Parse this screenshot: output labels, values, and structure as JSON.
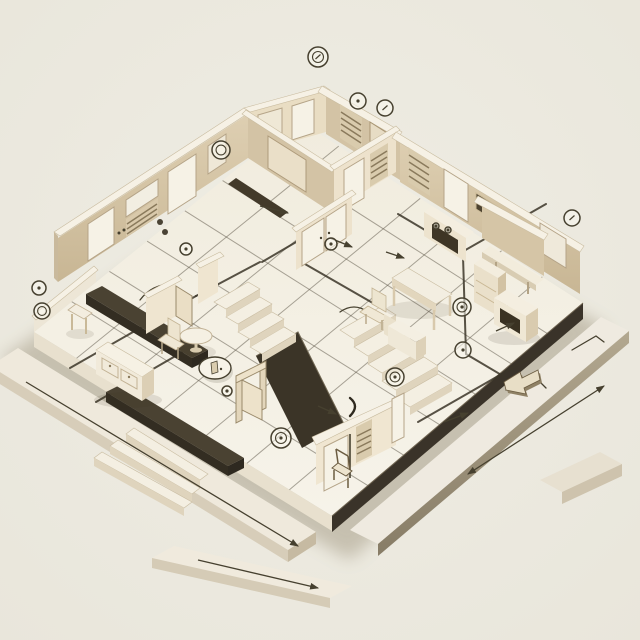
{
  "scene": {
    "label": "Isometric cutaway floor plan illustration in cream paper-model style",
    "depicted_elements": [
      "floor-grid",
      "staircase",
      "door",
      "double-door",
      "window",
      "radiator",
      "louver-panel",
      "round-table",
      "chair",
      "sideboard",
      "desk",
      "armchair",
      "nightstand",
      "wardrobe-cabinet",
      "bench",
      "ladder-shelf",
      "dimension-arrow",
      "circled-marker",
      "door-swing-arc"
    ]
  },
  "palette": {
    "background": "#ECE9E0",
    "floor": "#F4F0E5",
    "wall_light": "#EFE5CF",
    "wall_tan": "#D6C6A8",
    "wood": "#C9B894",
    "panel_white": "#F6F2E6",
    "dark_band": "#3B3427",
    "ink": "#46402F",
    "shadow": "#B7AE9B"
  },
  "markers": [
    {
      "id": "m1",
      "x": 318,
      "y": 57,
      "r": 10,
      "type": "double-ring-tick"
    },
    {
      "id": "m2",
      "x": 358,
      "y": 101,
      "r": 8,
      "type": "ring-dot"
    },
    {
      "id": "m3",
      "x": 385,
      "y": 108,
      "r": 8,
      "type": "ring-tick"
    },
    {
      "id": "m4",
      "x": 221,
      "y": 150,
      "r": 9,
      "type": "double-ring"
    },
    {
      "id": "m5",
      "x": 572,
      "y": 218,
      "r": 8,
      "type": "ring-tick"
    },
    {
      "id": "m6",
      "x": 39,
      "y": 288,
      "r": 7,
      "type": "ring-dot"
    },
    {
      "id": "m7",
      "x": 42,
      "y": 311,
      "r": 8,
      "type": "double-ring"
    },
    {
      "id": "m8",
      "x": 186,
      "y": 249,
      "r": 6,
      "type": "ring-dot"
    },
    {
      "id": "m9",
      "x": 331,
      "y": 244,
      "r": 6,
      "type": "ring-dot"
    },
    {
      "id": "m10",
      "x": 462,
      "y": 307,
      "r": 9,
      "type": "double-ring-dot"
    },
    {
      "id": "m11",
      "x": 463,
      "y": 350,
      "r": 8,
      "type": "ring-dot"
    },
    {
      "id": "m12",
      "x": 395,
      "y": 377,
      "r": 9,
      "type": "double-ring-dot"
    },
    {
      "id": "m13",
      "x": 281,
      "y": 438,
      "r": 10,
      "type": "double-ring-dot"
    },
    {
      "id": "m14",
      "x": 227,
      "y": 391,
      "r": 5,
      "type": "ring-dot"
    },
    {
      "id": "m15",
      "x": 215,
      "y": 368,
      "rx": 16,
      "ry": 11,
      "type": "ellipse-badge"
    },
    {
      "id": "m16",
      "x": 160,
      "y": 222,
      "r": 3,
      "type": "dot"
    },
    {
      "id": "m17",
      "x": 165,
      "y": 232,
      "r": 3,
      "type": "dot"
    },
    {
      "id": "m18",
      "x": 436,
      "y": 226,
      "r": 3,
      "type": "ring-dot"
    },
    {
      "id": "m19",
      "x": 448,
      "y": 230,
      "r": 3,
      "type": "ring-dot"
    }
  ],
  "arrows": [
    {
      "x1": 468,
      "y1": 474,
      "x2": 604,
      "y2": 386,
      "heads": "both"
    },
    {
      "x1": 26,
      "y1": 382,
      "x2": 298,
      "y2": 546,
      "heads": "end"
    },
    {
      "x1": 198,
      "y1": 560,
      "x2": 318,
      "y2": 588,
      "heads": "end"
    },
    {
      "x1": 260,
      "y1": 206,
      "x2": 288,
      "y2": 213,
      "heads": "end"
    },
    {
      "x1": 386,
      "y1": 252,
      "x2": 404,
      "y2": 258,
      "heads": "end"
    },
    {
      "x1": 496,
      "y1": 331,
      "x2": 514,
      "y2": 323,
      "heads": "end"
    },
    {
      "x1": 444,
      "y1": 422,
      "x2": 468,
      "y2": 413,
      "heads": "end"
    },
    {
      "x1": 318,
      "y1": 406,
      "x2": 336,
      "y2": 414,
      "heads": "end"
    },
    {
      "x1": 330,
      "y1": 238,
      "x2": 352,
      "y2": 247,
      "heads": "end"
    }
  ]
}
